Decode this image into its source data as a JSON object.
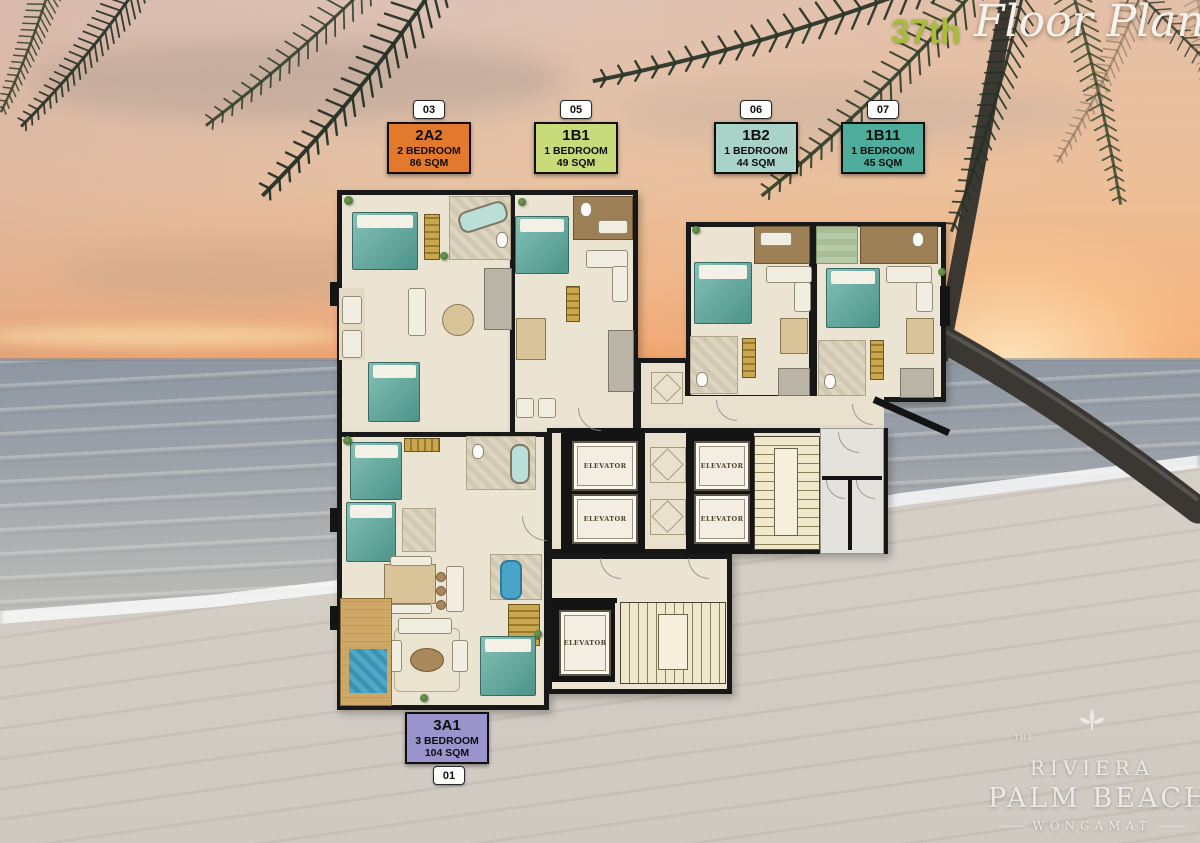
{
  "title": {
    "floor_number": "37th",
    "script_text": "Floor Plan"
  },
  "unit_labels": [
    {
      "badge": "03",
      "code": "2A2",
      "bedrooms": "2 BEDROOM",
      "area": "86 SQM",
      "color": "#e2792c"
    },
    {
      "badge": "05",
      "code": "1B1",
      "bedrooms": "1 BEDROOM",
      "area": "49 SQM",
      "color": "#c8da79"
    },
    {
      "badge": "06",
      "code": "1B2",
      "bedrooms": "1 BEDROOM",
      "area": "44 SQM",
      "color": "#a9d3c8"
    },
    {
      "badge": "07",
      "code": "1B11",
      "bedrooms": "1 BEDROOM",
      "area": "45 SQM",
      "color": "#4fad9c"
    },
    {
      "badge": "01",
      "code": "3A1",
      "bedrooms": "3 BEDROOM",
      "area": "104 SQM",
      "color": "#9a93cc"
    }
  ],
  "floor_plan": {
    "elevator_label": "ELEVATOR"
  },
  "logo": {
    "prefix": "THE",
    "name": "RIVIERA",
    "main": "PALM BEACH",
    "sub": "WONGAMAT"
  },
  "colors": {
    "title_accent": "#a7bd3b",
    "wall": "#181818",
    "corridor_marble": "#e9e1cd"
  }
}
